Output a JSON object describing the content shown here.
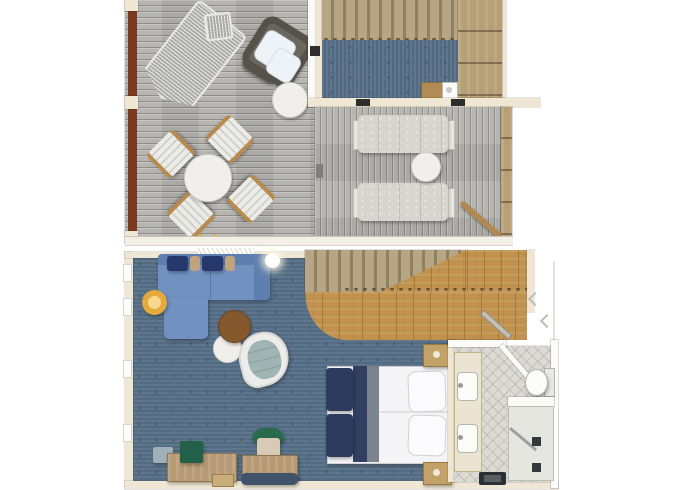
{
  "plan": {
    "levels": [
      {
        "name": "upper-level",
        "areas": [
          "open-sun-deck-left",
          "interior-landing-room",
          "open-sun-deck-right"
        ]
      },
      {
        "name": "lower-level",
        "areas": [
          "living-area",
          "bedroom",
          "entry-hall",
          "bathroom"
        ]
      }
    ]
  },
  "items": {
    "hammock": "hanging mesh lounger",
    "hammock_bar": "hammock spreader bar",
    "wicker_chair": "wicker lounge chair with white cushions",
    "deck_side_table": "round deck side table",
    "dining_table": "round outdoor dining table",
    "dining_chair": "outdoor dining chair",
    "deck_lights": "deck lights",
    "upper_stairs": "upper staircase",
    "stair_landing": "stair landing",
    "upper_carpet": "interior carpet",
    "bar_cabinet": "bar cabinet with sink",
    "sun_lounger": "sun lounger",
    "lounger_table": "round drinks table",
    "handrail": "deck stair handrail",
    "divider": "deck divider",
    "sofa": "L-shaped sofa with chaise",
    "pillow": "throw pillow",
    "floor_lamp": "floor lamp",
    "coffee_table": "round coffee table",
    "side_table": "round side table",
    "lounge_chair": "swivel lounge chair",
    "ceiling_light": "ceiling light",
    "curtain": "window treatment",
    "lower_stairs": "staircase to upper level",
    "entry_floor": "wood entry floor",
    "entry_door": "entry door swing",
    "bed": "double bed",
    "bed_runner": "bed foot runner",
    "bed_pillow": "bed pillow",
    "nightstand": "nightstand",
    "dresser": "dresser with storage box",
    "storage_box": "storage box",
    "desk": "writing desk",
    "desk_chair": "desk chair",
    "bench": "foot bench",
    "vanity": "double-sink vanity",
    "sink": "sink",
    "toilet": "toilet",
    "shower": "shower with drains",
    "shower_door": "shower glass door",
    "bath_mat": "bath mat",
    "window": "window mullion"
  },
  "palette": {
    "background": "#ffffff",
    "wall": "#efe7d4",
    "fixture": "#fbfbf8",
    "mahogany": "#7a3a20",
    "deck": "#b3b2ae",
    "carpet": "#567089",
    "stair": "#b6a686",
    "stair_gap": "#8f815f",
    "wood": "#c0924d",
    "landing": "#b7a076",
    "sofa": "#7191c1",
    "sofa_dark": "#5e7eb0",
    "pillow_navy": "#26376b",
    "pillow_tan": "#c0a47e",
    "lamp": "#e5a93c",
    "lamp_light": "#f7d98e",
    "coffee_table": "#85582e",
    "white_table": "#f0efeb",
    "lounge_shell": "#ececea",
    "lounge_cushion": "#9fb5b4",
    "bed_white": "#f4f4f6",
    "bed_navy": "#2d3b5f",
    "bed_gray": "#7b8290",
    "nightstand": "#c2a268",
    "green": "#2a6a4d",
    "desk": "#b59a74",
    "bench": "#3f5468",
    "tile": "#dddad4",
    "sun_lounger": "#d7d5d0",
    "wicker": "#56524a",
    "cushion_white": "#eef3f8",
    "marker_dark": "#2d2d2d"
  }
}
